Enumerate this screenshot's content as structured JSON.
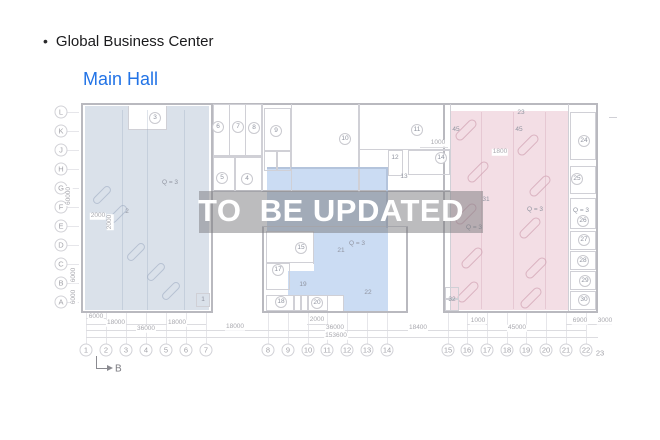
{
  "header": {
    "bullet": "•",
    "title": "Global Business Center",
    "subtitle": "Main Hall",
    "subtitle_color": "#2273e6",
    "title_color": "#1b1b1d"
  },
  "watermark": {
    "text": "TO  BE UPDATED",
    "band_color": "rgba(122,122,126,0.5)",
    "text_color": "#ffffff"
  },
  "plan": {
    "colors": {
      "wall_o": "#b9b9bf",
      "wall_i": "#d0d0d6",
      "wall_b": "#b4c4dc",
      "wall_f": "rgba(150,165,190,0.30)",
      "wall_p": "rgba(205,160,178,0.35)",
      "label": "#9094a0",
      "dim": "#a9a9af",
      "dim_line": "#dcdce0",
      "grid_line": "#e6e6ea",
      "circle_border": "#c9c9cf",
      "axis_border": "#d2d2d7",
      "axis_text": "#a2a2a8",
      "arrow": "#8a8a90"
    },
    "regions": [
      {
        "name": "left-zone",
        "color": "#dae1ea",
        "rects": [
          [
            85,
            106,
            124,
            204
          ]
        ]
      },
      {
        "name": "left-zone-notch",
        "color": "#ffffff",
        "rects": [
          [
            128,
            106,
            39,
            23
          ]
        ]
      },
      {
        "name": "middle-zone",
        "color": "#cbdcf3",
        "rects": [
          [
            267,
            168,
            121,
            64
          ],
          [
            314,
            232,
            74,
            64
          ],
          [
            288,
            271,
            38,
            25
          ],
          [
            343,
            296,
            45,
            15
          ]
        ]
      },
      {
        "name": "right-zone",
        "color": "#f3dee5",
        "rects": [
          [
            450,
            111,
            118,
            199
          ]
        ]
      }
    ],
    "hatches": {
      "left": {
        "color": "#b6c1d2",
        "w": 22,
        "h": 8,
        "cells": [
          [
            102,
            195
          ],
          [
            118,
            214
          ],
          [
            136,
            252
          ],
          [
            156,
            272
          ],
          [
            171,
            291
          ]
        ]
      },
      "right": {
        "color": "#dab2c0",
        "w": 26,
        "h": 9,
        "cells": [
          [
            466,
            130
          ],
          [
            478,
            172
          ],
          [
            466,
            214
          ],
          [
            472,
            258
          ],
          [
            468,
            292
          ],
          [
            528,
            145
          ],
          [
            540,
            186
          ],
          [
            530,
            228
          ],
          [
            536,
            268
          ],
          [
            531,
            298
          ]
        ]
      }
    },
    "walls": [
      [
        81,
        103,
        517,
        2,
        "o"
      ],
      [
        81,
        103,
        2,
        210,
        "o"
      ],
      [
        596,
        103,
        2,
        210,
        "o"
      ],
      [
        81,
        311,
        132,
        2,
        "o"
      ],
      [
        211,
        103,
        2,
        210,
        "o"
      ],
      [
        211,
        190,
        239,
        2,
        "o"
      ],
      [
        443,
        103,
        2,
        210,
        "o"
      ],
      [
        443,
        311,
        155,
        2,
        "o"
      ],
      [
        262,
        226,
        2,
        87,
        "o"
      ],
      [
        406,
        226,
        2,
        87,
        "o"
      ],
      [
        262,
        311,
        146,
        2,
        "o"
      ],
      [
        262,
        226,
        146,
        1,
        "i"
      ],
      [
        358,
        104,
        2,
        88,
        "i"
      ],
      [
        262,
        104,
        1,
        87,
        "i"
      ],
      [
        291,
        104,
        1,
        87,
        "i"
      ],
      [
        229,
        104,
        1,
        53,
        "i"
      ],
      [
        245,
        104,
        1,
        53,
        "i"
      ],
      [
        213,
        156,
        49,
        1,
        "i"
      ],
      [
        360,
        149,
        90,
        1,
        "i"
      ],
      [
        450,
        104,
        1,
        207,
        "i"
      ],
      [
        568,
        104,
        1,
        207,
        "i"
      ],
      [
        128,
        106,
        1,
        23,
        "i"
      ],
      [
        166,
        106,
        1,
        23,
        "i"
      ],
      [
        128,
        129,
        39,
        1,
        "i"
      ],
      [
        313,
        231,
        1,
        33,
        "i"
      ],
      [
        266,
        262,
        48,
        1,
        "i"
      ],
      [
        289,
        263,
        1,
        27,
        "i"
      ],
      [
        266,
        289,
        24,
        1,
        "i"
      ],
      [
        266,
        295,
        77,
        1,
        "i"
      ],
      [
        294,
        295,
        1,
        16,
        "i"
      ],
      [
        301,
        295,
        1,
        16,
        "i"
      ],
      [
        327,
        295,
        1,
        16,
        "i"
      ],
      [
        343,
        295,
        1,
        16,
        "i"
      ],
      [
        609,
        117,
        8,
        1,
        "i"
      ],
      [
        267,
        167,
        121,
        2,
        "b"
      ],
      [
        386,
        167,
        2,
        61,
        "b"
      ],
      [
        122,
        110,
        1,
        200,
        "f"
      ],
      [
        147,
        110,
        1,
        200,
        "f"
      ],
      [
        184,
        110,
        1,
        200,
        "f"
      ],
      [
        481,
        112,
        1,
        197,
        "p"
      ],
      [
        513,
        112,
        1,
        197,
        "p"
      ],
      [
        545,
        112,
        1,
        197,
        "p"
      ]
    ],
    "boxes": [
      [
        213,
        104,
        49,
        52
      ],
      [
        213,
        157,
        22,
        35
      ],
      [
        235,
        157,
        27,
        35
      ],
      [
        264,
        108,
        27,
        43
      ],
      [
        264,
        151,
        13,
        20
      ],
      [
        277,
        151,
        14,
        20
      ],
      [
        388,
        150,
        15,
        26
      ],
      [
        408,
        150,
        42,
        25
      ],
      [
        196,
        293,
        14,
        14
      ],
      [
        445,
        287,
        14,
        12
      ],
      [
        445,
        299,
        14,
        12
      ],
      [
        266,
        231,
        48,
        32
      ],
      [
        266,
        263,
        24,
        27
      ],
      [
        266,
        295,
        28,
        16
      ],
      [
        294,
        295,
        7,
        16
      ],
      [
        301,
        295,
        7,
        16
      ],
      [
        308,
        295,
        20,
        16
      ],
      [
        570,
        112,
        26,
        48
      ],
      [
        570,
        166,
        26,
        28
      ],
      [
        570,
        198,
        26,
        31
      ],
      [
        570,
        231,
        26,
        19
      ],
      [
        570,
        251,
        26,
        19
      ],
      [
        570,
        271,
        26,
        19
      ],
      [
        570,
        291,
        26,
        19
      ]
    ],
    "rows": [
      {
        "label": "L",
        "y": 112
      },
      {
        "label": "K",
        "y": 131
      },
      {
        "label": "J",
        "y": 150
      },
      {
        "label": "H",
        "y": 169
      },
      {
        "label": "G",
        "y": 188
      },
      {
        "label": "F",
        "y": 207
      },
      {
        "label": "E",
        "y": 226
      },
      {
        "label": "D",
        "y": 245
      },
      {
        "label": "C",
        "y": 264
      },
      {
        "label": "B",
        "y": 283
      },
      {
        "label": "A",
        "y": 302
      }
    ],
    "cols": [
      {
        "label": "1",
        "x": 86
      },
      {
        "label": "2",
        "x": 106
      },
      {
        "label": "3",
        "x": 126
      },
      {
        "label": "4",
        "x": 146
      },
      {
        "label": "5",
        "x": 166
      },
      {
        "label": "6",
        "x": 186
      },
      {
        "label": "7",
        "x": 206
      },
      {
        "label": "8",
        "x": 268
      },
      {
        "label": "9",
        "x": 288
      },
      {
        "label": "10",
        "x": 308
      },
      {
        "label": "11",
        "x": 327
      },
      {
        "label": "12",
        "x": 347
      },
      {
        "label": "13",
        "x": 367
      },
      {
        "label": "14",
        "x": 387
      },
      {
        "label": "15",
        "x": 448
      },
      {
        "label": "16",
        "x": 467
      },
      {
        "label": "17",
        "x": 487
      },
      {
        "label": "18",
        "x": 507
      },
      {
        "label": "19",
        "x": 526
      },
      {
        "label": "20",
        "x": 546
      },
      {
        "label": "21",
        "x": 566
      },
      {
        "label": "22",
        "x": 586
      }
    ],
    "col_extra": {
      "label": "23",
      "x": 600,
      "y": 353
    },
    "rooms_circled": [
      {
        "n": "3",
        "x": 155,
        "y": 118
      },
      {
        "n": "6",
        "x": 218,
        "y": 127
      },
      {
        "n": "7",
        "x": 238,
        "y": 127
      },
      {
        "n": "8",
        "x": 254,
        "y": 128
      },
      {
        "n": "5",
        "x": 222,
        "y": 178
      },
      {
        "n": "4",
        "x": 247,
        "y": 179
      },
      {
        "n": "9",
        "x": 276,
        "y": 131
      },
      {
        "n": "10",
        "x": 345,
        "y": 139
      },
      {
        "n": "11",
        "x": 417,
        "y": 130
      },
      {
        "n": "14",
        "x": 441,
        "y": 158
      },
      {
        "n": "15",
        "x": 301,
        "y": 248
      },
      {
        "n": "17",
        "x": 278,
        "y": 270
      },
      {
        "n": "18",
        "x": 281,
        "y": 302
      },
      {
        "n": "20",
        "x": 317,
        "y": 303
      },
      {
        "n": "24",
        "x": 584,
        "y": 141
      },
      {
        "n": "25",
        "x": 577,
        "y": 179
      },
      {
        "n": "26",
        "x": 583,
        "y": 221
      },
      {
        "n": "27",
        "x": 584,
        "y": 240
      },
      {
        "n": "28",
        "x": 583,
        "y": 261
      },
      {
        "n": "29",
        "x": 585,
        "y": 281
      },
      {
        "n": "30",
        "x": 584,
        "y": 300
      }
    ],
    "notes": [
      {
        "t": "12",
        "x": 395,
        "y": 158
      },
      {
        "t": "13",
        "x": 404,
        "y": 177
      },
      {
        "t": "19",
        "x": 303,
        "y": 285
      },
      {
        "t": "21",
        "x": 341,
        "y": 251
      },
      {
        "t": "22",
        "x": 368,
        "y": 293
      },
      {
        "t": "23",
        "x": 521,
        "y": 113
      },
      {
        "t": "31",
        "x": 486,
        "y": 200
      },
      {
        "t": "32",
        "x": 452,
        "y": 300
      },
      {
        "t": "1",
        "x": 203,
        "y": 300
      },
      {
        "t": "2",
        "x": 127,
        "y": 212
      },
      {
        "t": "Q = 3",
        "x": 170,
        "y": 183
      },
      {
        "t": "Q = 3",
        "x": 357,
        "y": 244
      },
      {
        "t": "Q = 3",
        "x": 474,
        "y": 228
      },
      {
        "t": "Q = 3",
        "x": 535,
        "y": 210
      },
      {
        "t": "Q = 3",
        "x": 581,
        "y": 211
      },
      {
        "t": "45",
        "x": 456,
        "y": 130
      },
      {
        "t": "45",
        "x": 519,
        "y": 130
      }
    ],
    "dims": [
      {
        "t": "6000",
        "x": 96,
        "y": 317
      },
      {
        "t": "18000",
        "x": 116,
        "y": 323
      },
      {
        "t": "18000",
        "x": 177,
        "y": 323
      },
      {
        "t": "36000",
        "x": 146,
        "y": 329
      },
      {
        "t": "18000",
        "x": 235,
        "y": 327
      },
      {
        "t": "2000",
        "x": 317,
        "y": 320
      },
      {
        "t": "36000",
        "x": 335,
        "y": 328
      },
      {
        "t": "18400",
        "x": 418,
        "y": 328
      },
      {
        "t": "153600",
        "x": 336,
        "y": 336
      },
      {
        "t": "1000",
        "x": 478,
        "y": 321
      },
      {
        "t": "45000",
        "x": 517,
        "y": 328
      },
      {
        "t": "6900",
        "x": 580,
        "y": 321
      },
      {
        "t": "3000",
        "x": 605,
        "y": 321
      },
      {
        "t": "1800",
        "x": 500,
        "y": 152
      },
      {
        "t": "1000",
        "x": 438,
        "y": 143
      },
      {
        "t": "2000",
        "x": 98,
        "y": 216
      },
      {
        "t": "60000",
        "x": 69,
        "y": 196,
        "r": 1
      },
      {
        "t": "6000",
        "x": 74,
        "y": 275,
        "r": 1
      },
      {
        "t": "6000",
        "x": 74,
        "y": 297,
        "r": 1
      },
      {
        "t": "2000",
        "x": 110,
        "y": 222,
        "r": 1
      }
    ],
    "dim_lines": [
      [
        86,
        318,
        20
      ],
      [
        86,
        324,
        120
      ],
      [
        86,
        330,
        120
      ],
      [
        206,
        330,
        62
      ],
      [
        307,
        324,
        20
      ],
      [
        268,
        330,
        119
      ],
      [
        387,
        330,
        61
      ],
      [
        86,
        337,
        512
      ],
      [
        467,
        324,
        20
      ],
      [
        448,
        330,
        138
      ],
      [
        566,
        324,
        32
      ],
      [
        598,
        324,
        14
      ],
      [
        420,
        147,
        28
      ]
    ],
    "section_label": "B"
  }
}
